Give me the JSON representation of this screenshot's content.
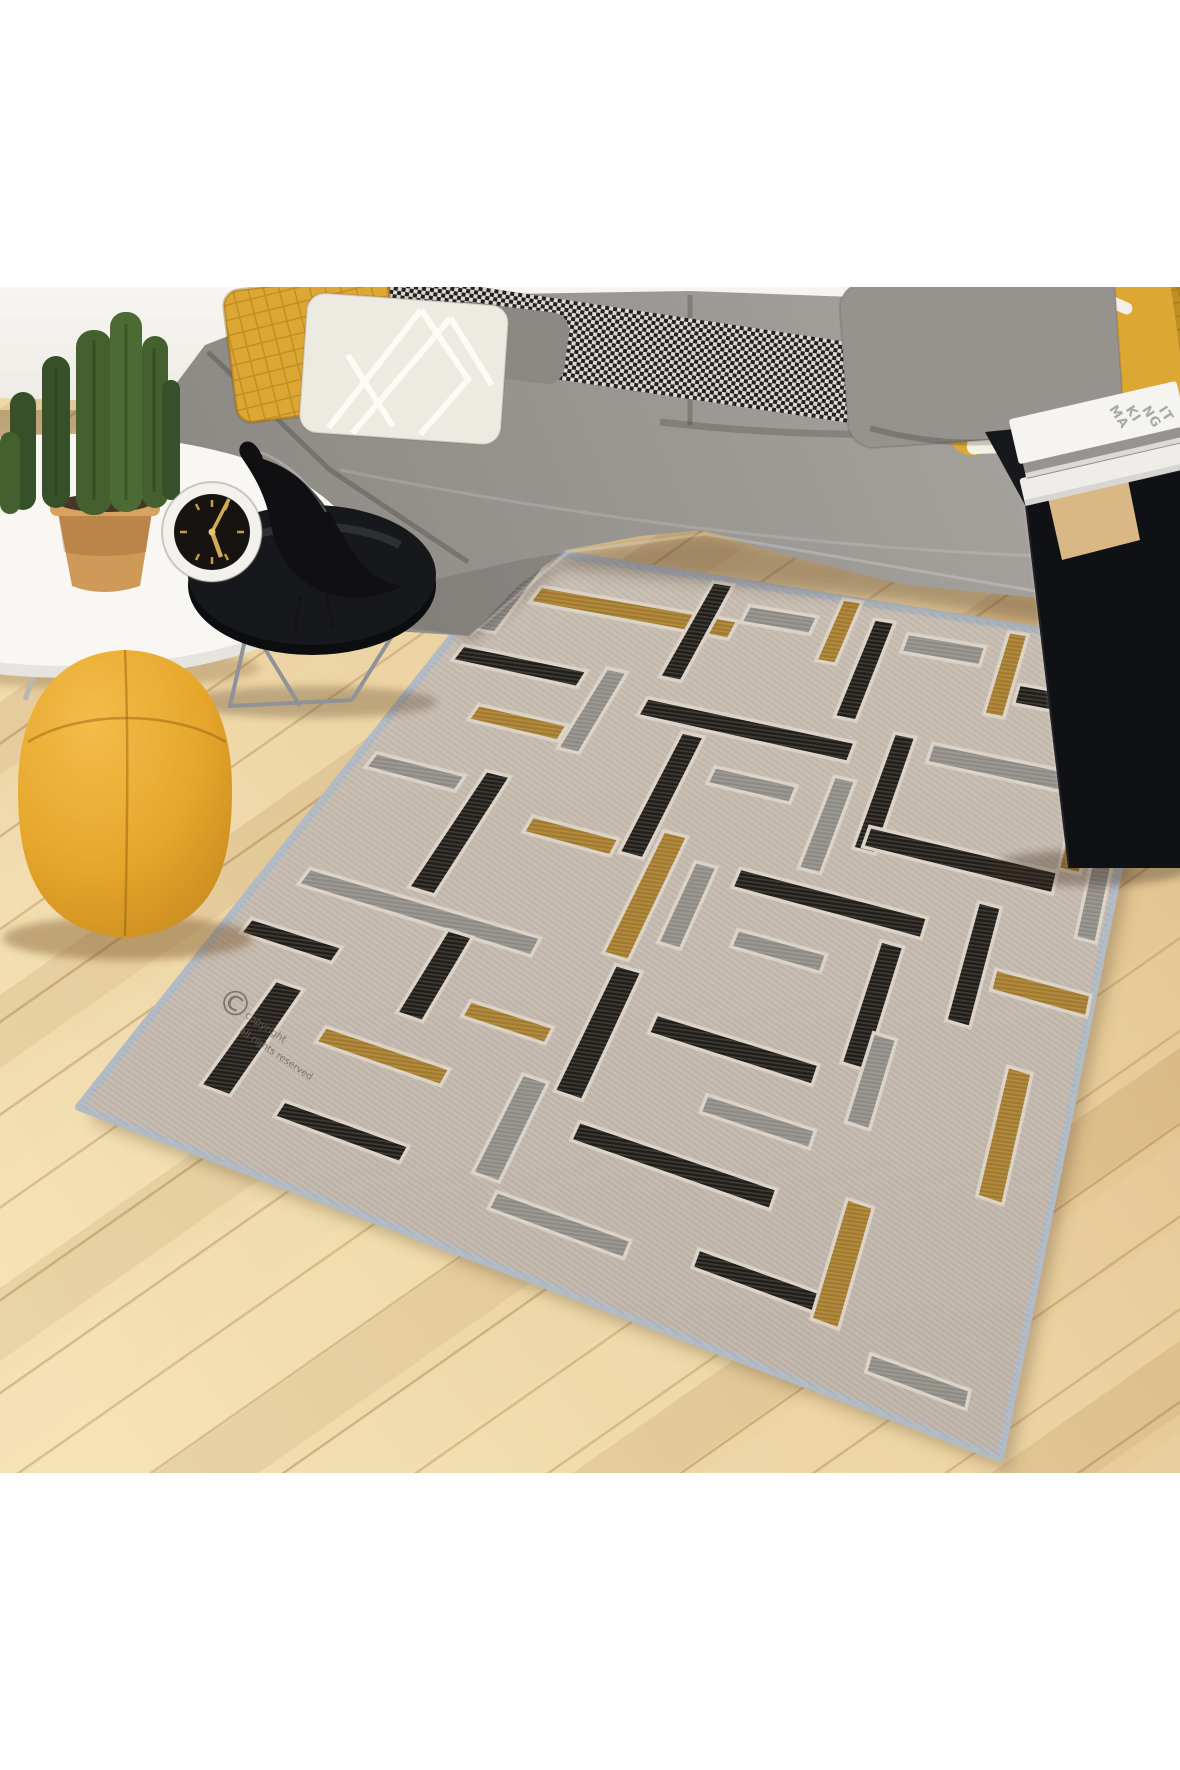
{
  "colors": {
    "page_bg": "#ffffff",
    "wall": "#f3f1ec",
    "floor_light": "#f3e0b2",
    "floor_mid": "#e9cf9d",
    "floor_dark": "#dcba84",
    "sofa_light": "#a8a5a0",
    "sofa_dark": "#8d8a85",
    "pillow_yellow": "#dda733",
    "pillow_yellow_deep": "#c08f22",
    "pillow_white": "#edeae2",
    "pillow_gray": "#96938e",
    "lumbar_gray": "#8c8984",
    "pouf": "#e9a92d",
    "table_black": "#17181b",
    "table_black_side": "#101114",
    "wood_slat": "#d9b886",
    "book_white": "#f5f4f1",
    "book_gray": "#96948f",
    "book_white2": "#efedea",
    "clock_ring": "#f3f1ec",
    "clock_face": "#161310",
    "clock_gold": "#c59d4a",
    "pot_light": "#cf9a58",
    "pot_rim": "#d9a260",
    "pot_soil": "#473526",
    "cactus_main": "#44602e",
    "cactus_dark": "#36512a",
    "cactus_mid": "#4c6a34",
    "table_white": "#f8f7f4",
    "chrome": "#9a9da1"
  },
  "objects": {
    "sofa": "grey L-shaped sectional sofa",
    "rug": "beige rug with black, grey and gold geometric bars",
    "pouf": "yellow pouf",
    "cactus": "potted cactus plant",
    "clock": "white rim alarm clock",
    "bird": "black bird figurine",
    "books": "stack of books",
    "bolster": "houndstooth bolster pillow"
  },
  "decor": {
    "books": {
      "title_lines": [
        "MA",
        "KI",
        "NG",
        "IT"
      ]
    }
  },
  "rug": {
    "base_color": "#c9bfb3",
    "base_color2": "#c0b5a9",
    "binding_color": "#b2bac3",
    "carve_color": "#dbd2c6",
    "shadow_color": "rgba(92,68,45,0.30)",
    "corners": {
      "n": [
        523,
        548
      ],
      "e": [
        1163,
        650
      ],
      "s": [
        1000,
        1458
      ],
      "w": [
        79,
        1107
      ]
    },
    "palette": {
      "black": "#211d18",
      "silver": "#8e8b85",
      "gold": "#a37a2b"
    },
    "copyright": {
      "symbol": "©",
      "line1": "copyright",
      "line2": "all rights reserved",
      "color": "#6a6459"
    },
    "bars": [
      {
        "u": 0.02,
        "v": 0.015,
        "w": 0.03,
        "h": 0.125,
        "c": "silver"
      },
      {
        "u": 0.065,
        "v": 0.055,
        "w": 0.3,
        "h": 0.028,
        "c": "gold"
      },
      {
        "u": 0.3,
        "v": 0.005,
        "w": 0.032,
        "h": 0.15,
        "c": "black"
      },
      {
        "u": 0.37,
        "v": 0.03,
        "w": 0.105,
        "h": 0.026,
        "c": "silver"
      },
      {
        "u": 0.5,
        "v": 0.0,
        "w": 0.03,
        "h": 0.09,
        "c": "gold"
      },
      {
        "u": 0.558,
        "v": 0.02,
        "w": 0.032,
        "h": 0.14,
        "c": "black"
      },
      {
        "u": 0.615,
        "v": 0.032,
        "w": 0.12,
        "h": 0.026,
        "c": "silver"
      },
      {
        "u": 0.762,
        "v": 0.008,
        "w": 0.03,
        "h": 0.11,
        "c": "gold"
      },
      {
        "u": 0.948,
        "v": 0.035,
        "w": 0.03,
        "h": 0.13,
        "c": "silver"
      },
      {
        "u": 0.8,
        "v": 0.072,
        "w": 0.145,
        "h": 0.026,
        "c": "black"
      },
      {
        "u": 0.022,
        "v": 0.168,
        "w": 0.18,
        "h": 0.027,
        "c": "black"
      },
      {
        "u": 0.225,
        "v": 0.158,
        "w": 0.03,
        "h": 0.13,
        "c": "silver"
      },
      {
        "u": 0.3,
        "v": 0.188,
        "w": 0.3,
        "h": 0.028,
        "c": "black"
      },
      {
        "u": 0.648,
        "v": 0.165,
        "w": 0.031,
        "h": 0.16,
        "c": "black"
      },
      {
        "u": 0.705,
        "v": 0.168,
        "w": 0.21,
        "h": 0.026,
        "c": "silver"
      },
      {
        "u": 0.92,
        "v": 0.158,
        "w": 0.03,
        "h": 0.13,
        "c": "gold"
      },
      {
        "u": 0.095,
        "v": 0.252,
        "w": 0.125,
        "h": 0.026,
        "c": "gold"
      },
      {
        "u": 0.368,
        "v": 0.225,
        "w": 0.032,
        "h": 0.185,
        "c": "black"
      },
      {
        "u": 0.432,
        "v": 0.262,
        "w": 0.115,
        "h": 0.025,
        "c": "silver"
      },
      {
        "u": 0.59,
        "v": 0.238,
        "w": 0.03,
        "h": 0.13,
        "c": "silver"
      },
      {
        "u": 0.66,
        "v": 0.292,
        "w": 0.26,
        "h": 0.028,
        "c": "black"
      },
      {
        "u": 0.962,
        "v": 0.25,
        "w": 0.028,
        "h": 0.115,
        "c": "silver"
      },
      {
        "u": 0.018,
        "v": 0.36,
        "w": 0.12,
        "h": 0.026,
        "c": "silver"
      },
      {
        "u": 0.158,
        "v": 0.345,
        "w": 0.033,
        "h": 0.195,
        "c": "black"
      },
      {
        "u": 0.245,
        "v": 0.392,
        "w": 0.115,
        "h": 0.026,
        "c": "gold"
      },
      {
        "u": 0.408,
        "v": 0.365,
        "w": 0.032,
        "h": 0.185,
        "c": "gold"
      },
      {
        "u": 0.463,
        "v": 0.395,
        "w": 0.029,
        "h": 0.12,
        "c": "silver"
      },
      {
        "u": 0.52,
        "v": 0.388,
        "w": 0.25,
        "h": 0.028,
        "c": "black"
      },
      {
        "u": 0.828,
        "v": 0.352,
        "w": 0.031,
        "h": 0.155,
        "c": "black"
      },
      {
        "u": 0.872,
        "v": 0.428,
        "w": 0.125,
        "h": 0.027,
        "c": "gold"
      },
      {
        "u": 0.548,
        "v": 0.468,
        "w": 0.115,
        "h": 0.025,
        "c": "silver"
      },
      {
        "u": 0.722,
        "v": 0.432,
        "w": 0.03,
        "h": 0.165,
        "c": "black"
      },
      {
        "u": 0.042,
        "v": 0.555,
        "w": 0.29,
        "h": 0.028,
        "c": "silver"
      },
      {
        "u": 0.428,
        "v": 0.56,
        "w": 0.033,
        "h": 0.19,
        "c": "black"
      },
      {
        "u": 0.498,
        "v": 0.608,
        "w": 0.2,
        "h": 0.028,
        "c": "black"
      },
      {
        "u": 0.748,
        "v": 0.548,
        "w": 0.029,
        "h": 0.12,
        "c": "silver"
      },
      {
        "u": 0.915,
        "v": 0.54,
        "w": 0.031,
        "h": 0.165,
        "c": "gold"
      },
      {
        "u": 0.022,
        "v": 0.652,
        "w": 0.11,
        "h": 0.026,
        "c": "black"
      },
      {
        "u": 0.228,
        "v": 0.582,
        "w": 0.031,
        "h": 0.135,
        "c": "black"
      },
      {
        "u": 0.295,
        "v": 0.668,
        "w": 0.1,
        "h": 0.025,
        "c": "gold"
      },
      {
        "u": 0.588,
        "v": 0.69,
        "w": 0.13,
        "h": 0.025,
        "c": "silver"
      },
      {
        "u": 0.09,
        "v": 0.728,
        "w": 0.033,
        "h": 0.18,
        "c": "black"
      },
      {
        "u": 0.168,
        "v": 0.768,
        "w": 0.145,
        "h": 0.026,
        "c": "gold"
      },
      {
        "u": 0.388,
        "v": 0.742,
        "w": 0.03,
        "h": 0.15,
        "c": "silver"
      },
      {
        "u": 0.468,
        "v": 0.778,
        "w": 0.23,
        "h": 0.028,
        "c": "black"
      },
      {
        "u": 0.775,
        "v": 0.76,
        "w": 0.031,
        "h": 0.16,
        "c": "gold"
      },
      {
        "u": 0.175,
        "v": 0.888,
        "w": 0.14,
        "h": 0.026,
        "c": "black"
      },
      {
        "u": 0.42,
        "v": 0.905,
        "w": 0.15,
        "h": 0.026,
        "c": "silver"
      },
      {
        "u": 0.64,
        "v": 0.885,
        "w": 0.135,
        "h": 0.026,
        "c": "black"
      },
      {
        "u": 0.845,
        "v": 0.935,
        "w": 0.11,
        "h": 0.024,
        "c": "silver"
      }
    ]
  }
}
